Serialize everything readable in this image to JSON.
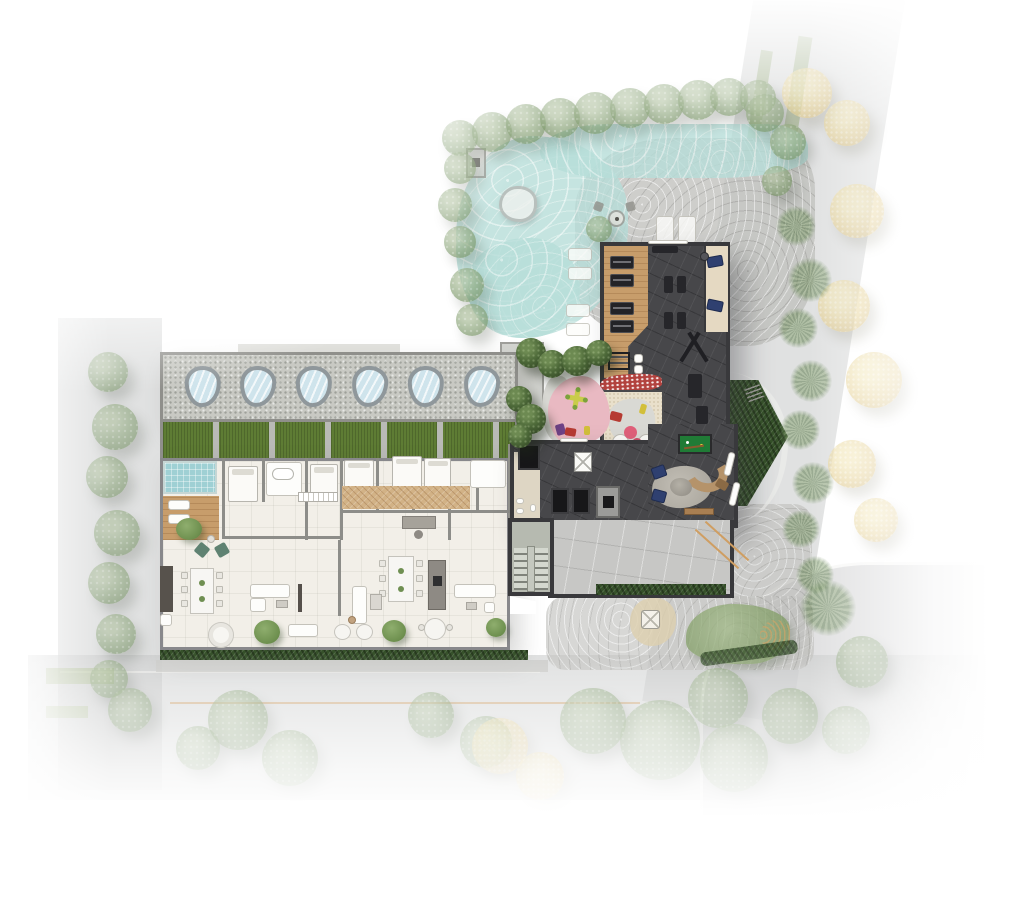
{
  "meta": {
    "type": "architectural-site-plan",
    "view": "top-down rendered ground-floor / implantation plan",
    "style": "color architectural rendering with faded street surroundings"
  },
  "palette": {
    "road": "#c7c8c9",
    "pool_water": "#b7ded9",
    "pool_deck": "#c2c2bf",
    "gravel_roof": "#c8c9c3",
    "lawn": "#5e7c34",
    "hedge": "#36512a",
    "apartment_floor": "#f2efe8",
    "wood_deck": "#c79d6b",
    "amenity_floor": "#47474a",
    "amenity_wall": "#39393c",
    "garage_floor": "#c7c7c5",
    "playground_pink": "#e9b9c2",
    "play_cross_yellow": "#c9cc4a",
    "mosaic_red": "#b2423e",
    "billiard_green": "#207b36",
    "navy_cushion": "#2f4070",
    "sofa_tan": "#b5936a",
    "plunge_pool": "#9fd0d4",
    "skylight": "#cfe4ec",
    "sand": "#e9e0cb",
    "stair_floor": "#b6bab0",
    "lane_line_orange": "#cf9e62",
    "tree_green": "#7d9769",
    "tree_yellow": "#e4cf8f"
  },
  "regions": {
    "pool_area": {
      "label": "Pool terrace: free-form pool, stone deck, sun loungers, parasol table, spa, perimeter trees"
    },
    "gym": {
      "label": "Fitness room: wood strip with weight benches, spin bikes, cable machine, daybed nook with navy cushions"
    },
    "residential_building": {
      "label": "Residential block: pebble roof band with organic skylights, lawn panels, furnished apartment plan, terrace with hedge",
      "skylight_count": 6,
      "lawn_panel_count": 6
    },
    "lobby": {
      "label": "Ground-floor core and lounge: elevators, stair, fireplace, curved sofa, billiards table"
    },
    "playground": {
      "label": "Kids playground: pink safety surface, cross play structure, toy cars, sand play area, red mosaic band"
    },
    "garage": {
      "label": "Driveway and garage ramp with hedge edge"
    },
    "landscape": {
      "label": "Streets, lawns and tree canopies (green, yellow-flowering, palms)"
    }
  }
}
